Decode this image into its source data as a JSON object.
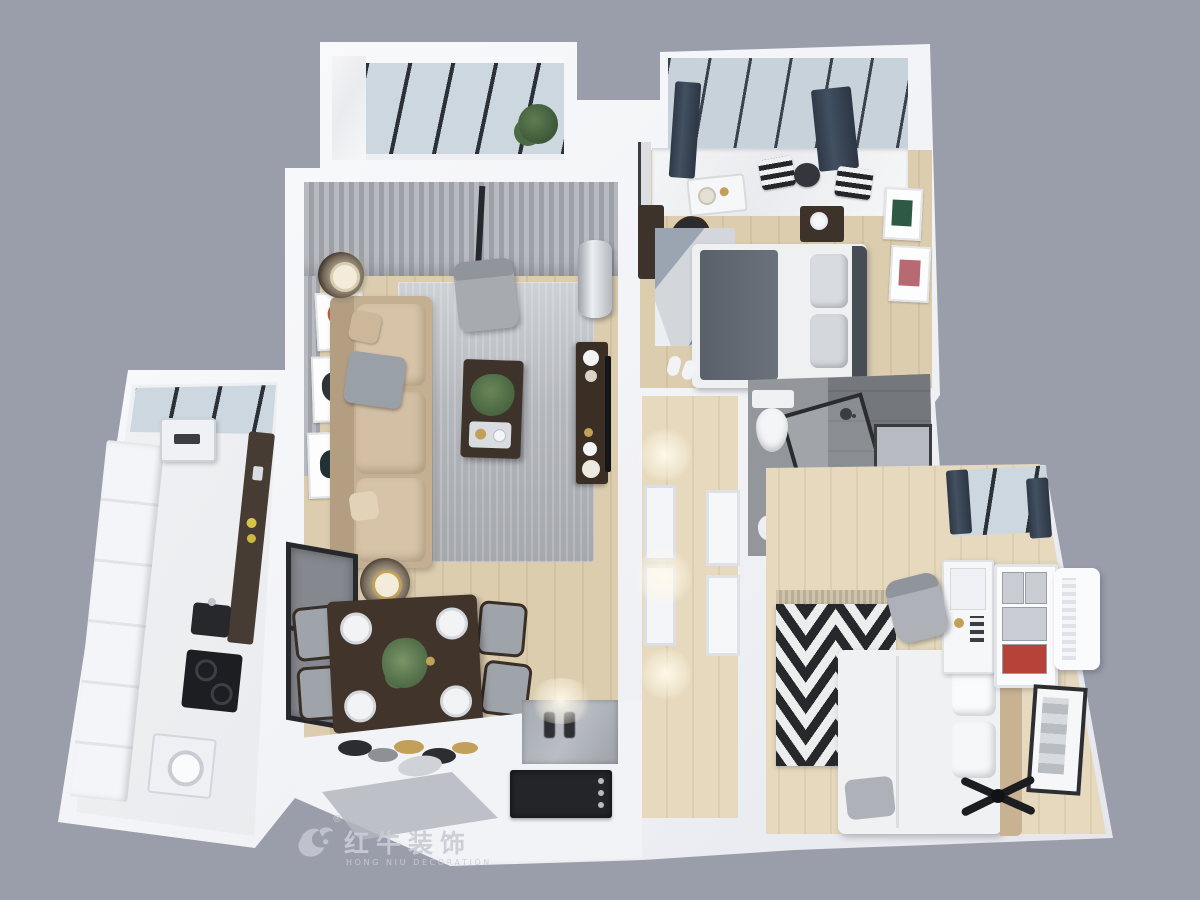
{
  "background_color": "#9a9daa",
  "watermark": {
    "brand_cn": "红牛装饰",
    "brand_en": "HONG NIU DECORATION",
    "registered_mark": "®",
    "logo": "bull-icon",
    "color": "#c9ccd6"
  },
  "palette": {
    "wall_white": "#f2f3f6",
    "wood_floor": "#d9cbae",
    "rug_gray": "#b6b9bd",
    "sofa_beige": "#cdb99e",
    "dark_wood": "#3e332a",
    "navy_curtain": "#36404e",
    "glass_blue": "#ccd7e0",
    "bath_tile": "#898c91",
    "chevron_dark": "#27282c",
    "accent_gold": "#c2a05a",
    "door_black": "#232529"
  },
  "scene": {
    "description": "Top-down 3D render of a two-bedroom apartment floor plan on gray backdrop",
    "rooms": [
      {
        "name": "balcony",
        "furniture": [
          "black-framed-glazing",
          "potted-plant",
          "marble-floor"
        ]
      },
      {
        "name": "living-room",
        "furniture": [
          "sheer-curtains",
          "beige-sectional-sofa",
          "wall-art-frames",
          "gray-area-rug",
          "gray-armchair",
          "dark-coffee-table",
          "tv-console",
          "cylindrical-ac-unit",
          "side-table-lamps"
        ]
      },
      {
        "name": "dining-area",
        "furniture": [
          "dark-dining-table",
          "four-gray-chairs",
          "centerpiece-plant",
          "black-frame-window",
          "decor-plates"
        ]
      },
      {
        "name": "kitchen",
        "furniture": [
          "slanted-window",
          "white-cabinet-run",
          "tall-pantry",
          "water-heater",
          "sink",
          "cooktop",
          "oven"
        ]
      },
      {
        "name": "entry",
        "furniture": [
          "black-entry-door",
          "marble-accent-wall",
          "gray-floor-mat"
        ]
      },
      {
        "name": "hallway",
        "furniture": [
          "ceiling-light-glows",
          "paneled-nook",
          "leaning-tv-panel"
        ]
      },
      {
        "name": "bedroom-primary",
        "furniture": [
          "window-seat",
          "navy-curtains",
          "striped-pillows",
          "breakfast-tray",
          "desk-and-chair",
          "geometric-rug",
          "bed-gray-bedding",
          "nightstand-flowers",
          "two-art-frames",
          "slippers"
        ]
      },
      {
        "name": "bathroom",
        "furniture": [
          "toilet",
          "glass-shower-partition",
          "wall-niche",
          "bath-mat",
          "shower-head"
        ]
      },
      {
        "name": "bedroom-second",
        "furniture": [
          "navy-curtain-window",
          "chevron-rug",
          "white-bed",
          "white-desk-pegboard",
          "desk-chair",
          "shelving-unit",
          "wall-ac-unit",
          "framed-art",
          "ceiling-fan"
        ]
      }
    ]
  }
}
